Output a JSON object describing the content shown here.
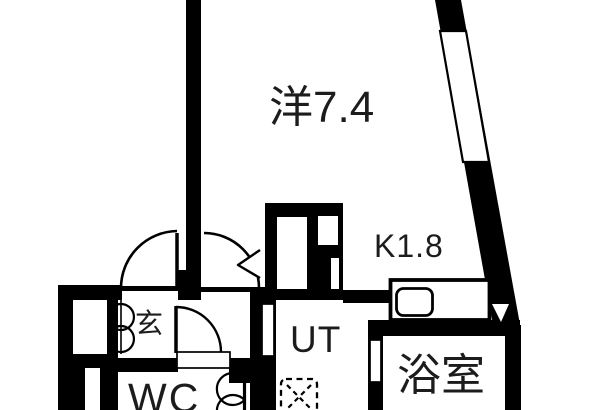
{
  "plan_title": "apartment-floor-plan",
  "colors": {
    "wall": "#000000",
    "floor": "#ffffff",
    "label": "#1c1c1c"
  },
  "rooms": {
    "western": {
      "label": "洋7.4"
    },
    "kitchen": {
      "label": "K1.8"
    },
    "entrance": {
      "label": "玄"
    },
    "utility": {
      "label": "UT"
    },
    "toilet": {
      "label": "WC"
    },
    "bathroom": {
      "label": "浴室"
    }
  }
}
